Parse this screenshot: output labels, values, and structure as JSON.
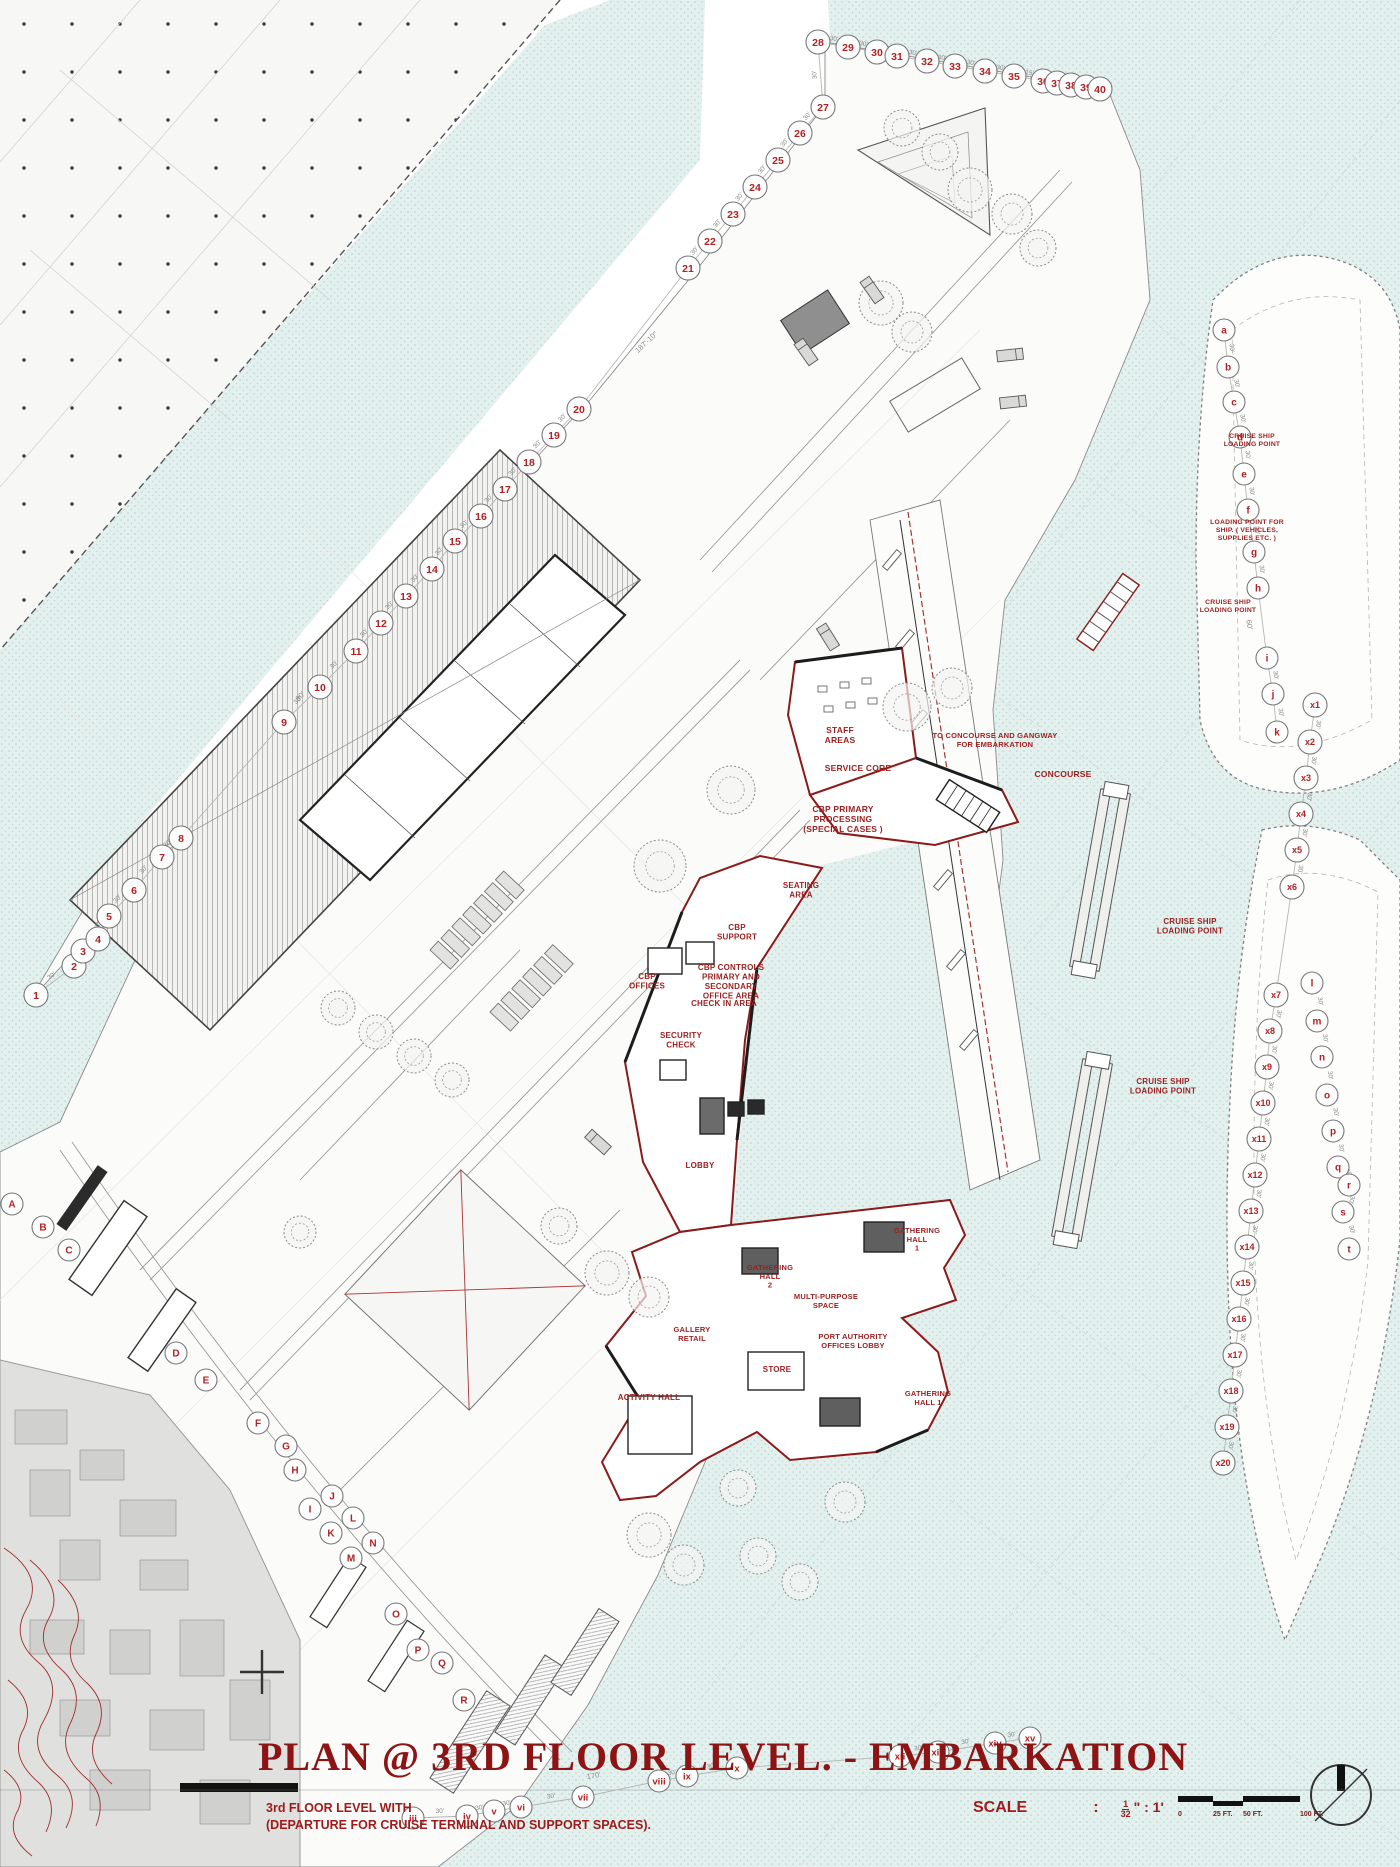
{
  "titleblock": {
    "title": "PLAN @ 3RD FLOOR LEVEL. - EMBARKATION",
    "subtitle_line1": "3rd FLOOR LEVEL WITH",
    "subtitle_line2": "(DEPARTURE FOR CRUISE TERMINAL AND SUPPORT SPACES)."
  },
  "scale_bar": {
    "label": "SCALE",
    "colon": ":",
    "ratio_numerator": "1",
    "ratio_denominator": "32",
    "ratio_suffix": "\" : 1'",
    "ticks": [
      {
        "t": "0",
        "x": 1178
      },
      {
        "t": "25 FT.",
        "x": 1213
      },
      {
        "t": "50 FT.",
        "x": 1243
      },
      {
        "t": "100 FT.",
        "x": 1300
      }
    ]
  },
  "colors": {
    "label_red": "#9c1f1f",
    "small_label_red": "#b02a2a",
    "title_red": "#8c1414",
    "water": "#e3f0ee",
    "chain_line": "#b5b5b5",
    "marker_stroke": "#777777",
    "marker_text": "#b22222",
    "dim_text": "#8a8a8a"
  },
  "plan_labels": [
    {
      "t": "STAFF|AREAS",
      "x": 840,
      "y": 733,
      "s": 8.5
    },
    {
      "t": "SERVICE CORE",
      "x": 858,
      "y": 771,
      "s": 8.5
    },
    {
      "t": "CBP PRIMARY|PROCESSING|(SPECIAL CASES )",
      "x": 843,
      "y": 812,
      "s": 8.5
    },
    {
      "t": "TO CONCOURSE AND GANGWAY|FOR EMBARKATION",
      "x": 995,
      "y": 738,
      "s": 7.5
    },
    {
      "t": "CONCOURSE",
      "x": 1063,
      "y": 777,
      "s": 8.5
    },
    {
      "t": "SEATING|AREA",
      "x": 801,
      "y": 888,
      "s": 8
    },
    {
      "t": "CBP|SUPPORT",
      "x": 737,
      "y": 930,
      "s": 8
    },
    {
      "t": "CBP CONTROLS|PRIMARY AND|SECONDARY|OFFICE AREA",
      "x": 731,
      "y": 970,
      "s": 8
    },
    {
      "t": "CBP|OFFICES",
      "x": 647,
      "y": 979,
      "s": 8
    },
    {
      "t": "CHECK IN AREA",
      "x": 724,
      "y": 1006,
      "s": 8
    },
    {
      "t": "SECURITY|CHECK",
      "x": 681,
      "y": 1038,
      "s": 8
    },
    {
      "t": "LOBBY",
      "x": 700,
      "y": 1168,
      "s": 8
    },
    {
      "t": "GATHERING|HALL|1",
      "x": 917,
      "y": 1233,
      "s": 7.5
    },
    {
      "t": "GATHERING|HALL|2",
      "x": 770,
      "y": 1270,
      "s": 7.5
    },
    {
      "t": "MULTI-PURPOSE|SPACE",
      "x": 826,
      "y": 1299,
      "s": 7.5
    },
    {
      "t": "PORT AUTHORITY|OFFICES LOBBY",
      "x": 853,
      "y": 1339,
      "s": 7.5
    },
    {
      "t": "GALLERY|RETAIL",
      "x": 692,
      "y": 1332,
      "s": 7.5
    },
    {
      "t": "STORE",
      "x": 777,
      "y": 1372,
      "s": 8
    },
    {
      "t": "ACTIVITY HALL",
      "x": 649,
      "y": 1400,
      "s": 8
    },
    {
      "t": "GATHERING|HALL 1",
      "x": 928,
      "y": 1396,
      "s": 7.5
    },
    {
      "t": "CRUISE SHIP|LOADING POINT",
      "x": 1252,
      "y": 438,
      "s": 6.8
    },
    {
      "t": "LOADING POINT FOR|SHIP. ( VEHICLES,|SUPPLIES ETC. )",
      "x": 1247,
      "y": 524,
      "s": 6.8
    },
    {
      "t": "CRUISE SHIP|LOADING POINT",
      "x": 1228,
      "y": 604,
      "s": 6.8
    },
    {
      "t": "CRUISE SHIP|LOADING POINT",
      "x": 1190,
      "y": 924,
      "s": 8
    },
    {
      "t": "CRUISE SHIP|LOADING POINT",
      "x": 1163,
      "y": 1084,
      "s": 8
    }
  ],
  "dim_labels": [
    {
      "t": "187'-10\"",
      "x": 648,
      "y": 344,
      "rot": -43
    },
    {
      "t": "60'",
      "x": 1247,
      "y": 625,
      "rot": 82
    },
    {
      "t": "90'",
      "x": 302,
      "y": 698,
      "rot": -47
    },
    {
      "t": "170'",
      "x": 594,
      "y": 1778,
      "rot": -9
    }
  ],
  "grid_chains": [
    {
      "name": "grid-numbers",
      "r": 12,
      "fs": 10.5,
      "dim": "30'",
      "line": true,
      "dim_overrides": {
        "34": "15'",
        "35": "15'",
        "36": "15'",
        "37": "15'",
        "38": "15'"
      },
      "pts": [
        [
          "1",
          36,
          995
        ],
        [
          "2",
          74,
          966
        ],
        [
          "3",
          83,
          951
        ],
        [
          "4",
          98,
          939
        ],
        [
          "5",
          109,
          916
        ],
        [
          "6",
          134,
          890
        ],
        [
          "7",
          162,
          857
        ],
        [
          "8",
          181,
          838
        ],
        [
          "9",
          284,
          722
        ],
        [
          "10",
          320,
          687
        ],
        [
          "11",
          356,
          651
        ],
        [
          "12",
          381,
          623
        ],
        [
          "13",
          406,
          596
        ],
        [
          "14",
          432,
          569
        ],
        [
          "15",
          455,
          541
        ],
        [
          "16",
          481,
          516
        ],
        [
          "17",
          505,
          489
        ],
        [
          "18",
          529,
          462
        ],
        [
          "19",
          554,
          435
        ],
        [
          "20",
          579,
          409
        ],
        [
          "21",
          688,
          268
        ],
        [
          "22",
          710,
          241
        ],
        [
          "23",
          733,
          214
        ],
        [
          "24",
          755,
          187
        ],
        [
          "25",
          778,
          160
        ],
        [
          "26",
          800,
          133
        ],
        [
          "27",
          823,
          107
        ],
        [
          "28",
          818,
          42
        ],
        [
          "29",
          848,
          47
        ],
        [
          "30",
          877,
          52
        ],
        [
          "31",
          897,
          56
        ],
        [
          "32",
          927,
          61
        ],
        [
          "33",
          955,
          66
        ],
        [
          "34",
          985,
          71
        ],
        [
          "35",
          1014,
          76
        ],
        [
          "36",
          1043,
          81
        ],
        [
          "37",
          1057,
          83
        ],
        [
          "38",
          1071,
          85
        ],
        [
          "39",
          1086,
          87
        ],
        [
          "40",
          1100,
          89
        ]
      ]
    },
    {
      "name": "berth-letters",
      "r": 11,
      "fs": 10,
      "dim": "30'",
      "line": true,
      "dim_overrides": {},
      "pts": [
        [
          "a",
          1224,
          330
        ],
        [
          "b",
          1228,
          367
        ],
        [
          "c",
          1234,
          402
        ],
        [
          "d",
          1240,
          437
        ],
        [
          "e",
          1244,
          474
        ],
        [
          "f",
          1248,
          510
        ],
        [
          "g",
          1254,
          552
        ],
        [
          "h",
          1258,
          588
        ],
        [
          "i",
          1267,
          658
        ],
        [
          "j",
          1273,
          694
        ],
        [
          "k",
          1277,
          732
        ]
      ]
    },
    {
      "name": "x-gridline",
      "r": 12,
      "fs": 9,
      "dim": "30'",
      "line": true,
      "dim_overrides": {},
      "pts": [
        [
          "x1",
          1315,
          705
        ],
        [
          "x2",
          1310,
          742
        ],
        [
          "x3",
          1306,
          778
        ],
        [
          "x4",
          1301,
          814
        ],
        [
          "x5",
          1297,
          850
        ],
        [
          "x6",
          1292,
          887
        ],
        [
          "x7",
          1276,
          995
        ],
        [
          "x8",
          1270,
          1031
        ],
        [
          "x9",
          1267,
          1067
        ],
        [
          "x10",
          1263,
          1103
        ],
        [
          "x11",
          1259,
          1139
        ],
        [
          "x12",
          1255,
          1175
        ],
        [
          "x13",
          1251,
          1211
        ],
        [
          "x14",
          1247,
          1247
        ],
        [
          "x15",
          1243,
          1283
        ],
        [
          "x16",
          1239,
          1319
        ],
        [
          "x17",
          1235,
          1355
        ],
        [
          "x18",
          1231,
          1391
        ],
        [
          "x19",
          1227,
          1427
        ],
        [
          "x20",
          1223,
          1463
        ]
      ]
    },
    {
      "name": "ship-right-letters",
      "r": 11,
      "fs": 10,
      "dim": "30'",
      "line": false,
      "dim_overrides": {},
      "pts": [
        [
          "l",
          1312,
          983
        ],
        [
          "m",
          1317,
          1021
        ],
        [
          "n",
          1322,
          1057
        ],
        [
          "o",
          1327,
          1095
        ],
        [
          "p",
          1333,
          1131
        ],
        [
          "q",
          1338,
          1167
        ],
        [
          "r",
          1349,
          1185
        ],
        [
          "s",
          1343,
          1212
        ],
        [
          "t",
          1349,
          1249
        ]
      ]
    },
    {
      "name": "shore-letters",
      "r": 11,
      "fs": 10,
      "dim": null,
      "line": false,
      "dim_overrides": {},
      "pts": [
        [
          "A",
          12,
          1204
        ],
        [
          "B",
          43,
          1227
        ],
        [
          "C",
          69,
          1250
        ],
        [
          "D",
          176,
          1353
        ],
        [
          "E",
          206,
          1380
        ],
        [
          "F",
          258,
          1423
        ],
        [
          "G",
          286,
          1446
        ],
        [
          "H",
          295,
          1470
        ],
        [
          "I",
          310,
          1509
        ],
        [
          "J",
          332,
          1496
        ],
        [
          "K",
          331,
          1533
        ],
        [
          "L",
          353,
          1518
        ],
        [
          "M",
          351,
          1558
        ],
        [
          "N",
          373,
          1543
        ],
        [
          "O",
          396,
          1614
        ],
        [
          "P",
          418,
          1650
        ],
        [
          "Q",
          442,
          1663
        ],
        [
          "R",
          464,
          1700
        ]
      ]
    },
    {
      "name": "roman-letters",
      "r": 11,
      "fs": 9.5,
      "dim": "30'",
      "line": true,
      "dim_overrides": {},
      "pts": [
        [
          "iii",
          413,
          1818
        ],
        [
          "iv",
          467,
          1816
        ],
        [
          "v",
          494,
          1811
        ],
        [
          "vi",
          521,
          1807
        ],
        [
          "vii",
          583,
          1797
        ],
        [
          "viii",
          659,
          1781
        ],
        [
          "ix",
          687,
          1776
        ],
        [
          "x",
          737,
          1768
        ],
        [
          "xii",
          900,
          1756
        ],
        [
          "xiii",
          938,
          1752
        ],
        [
          "xiv",
          995,
          1743
        ],
        [
          "xv",
          1030,
          1738
        ]
      ]
    }
  ]
}
